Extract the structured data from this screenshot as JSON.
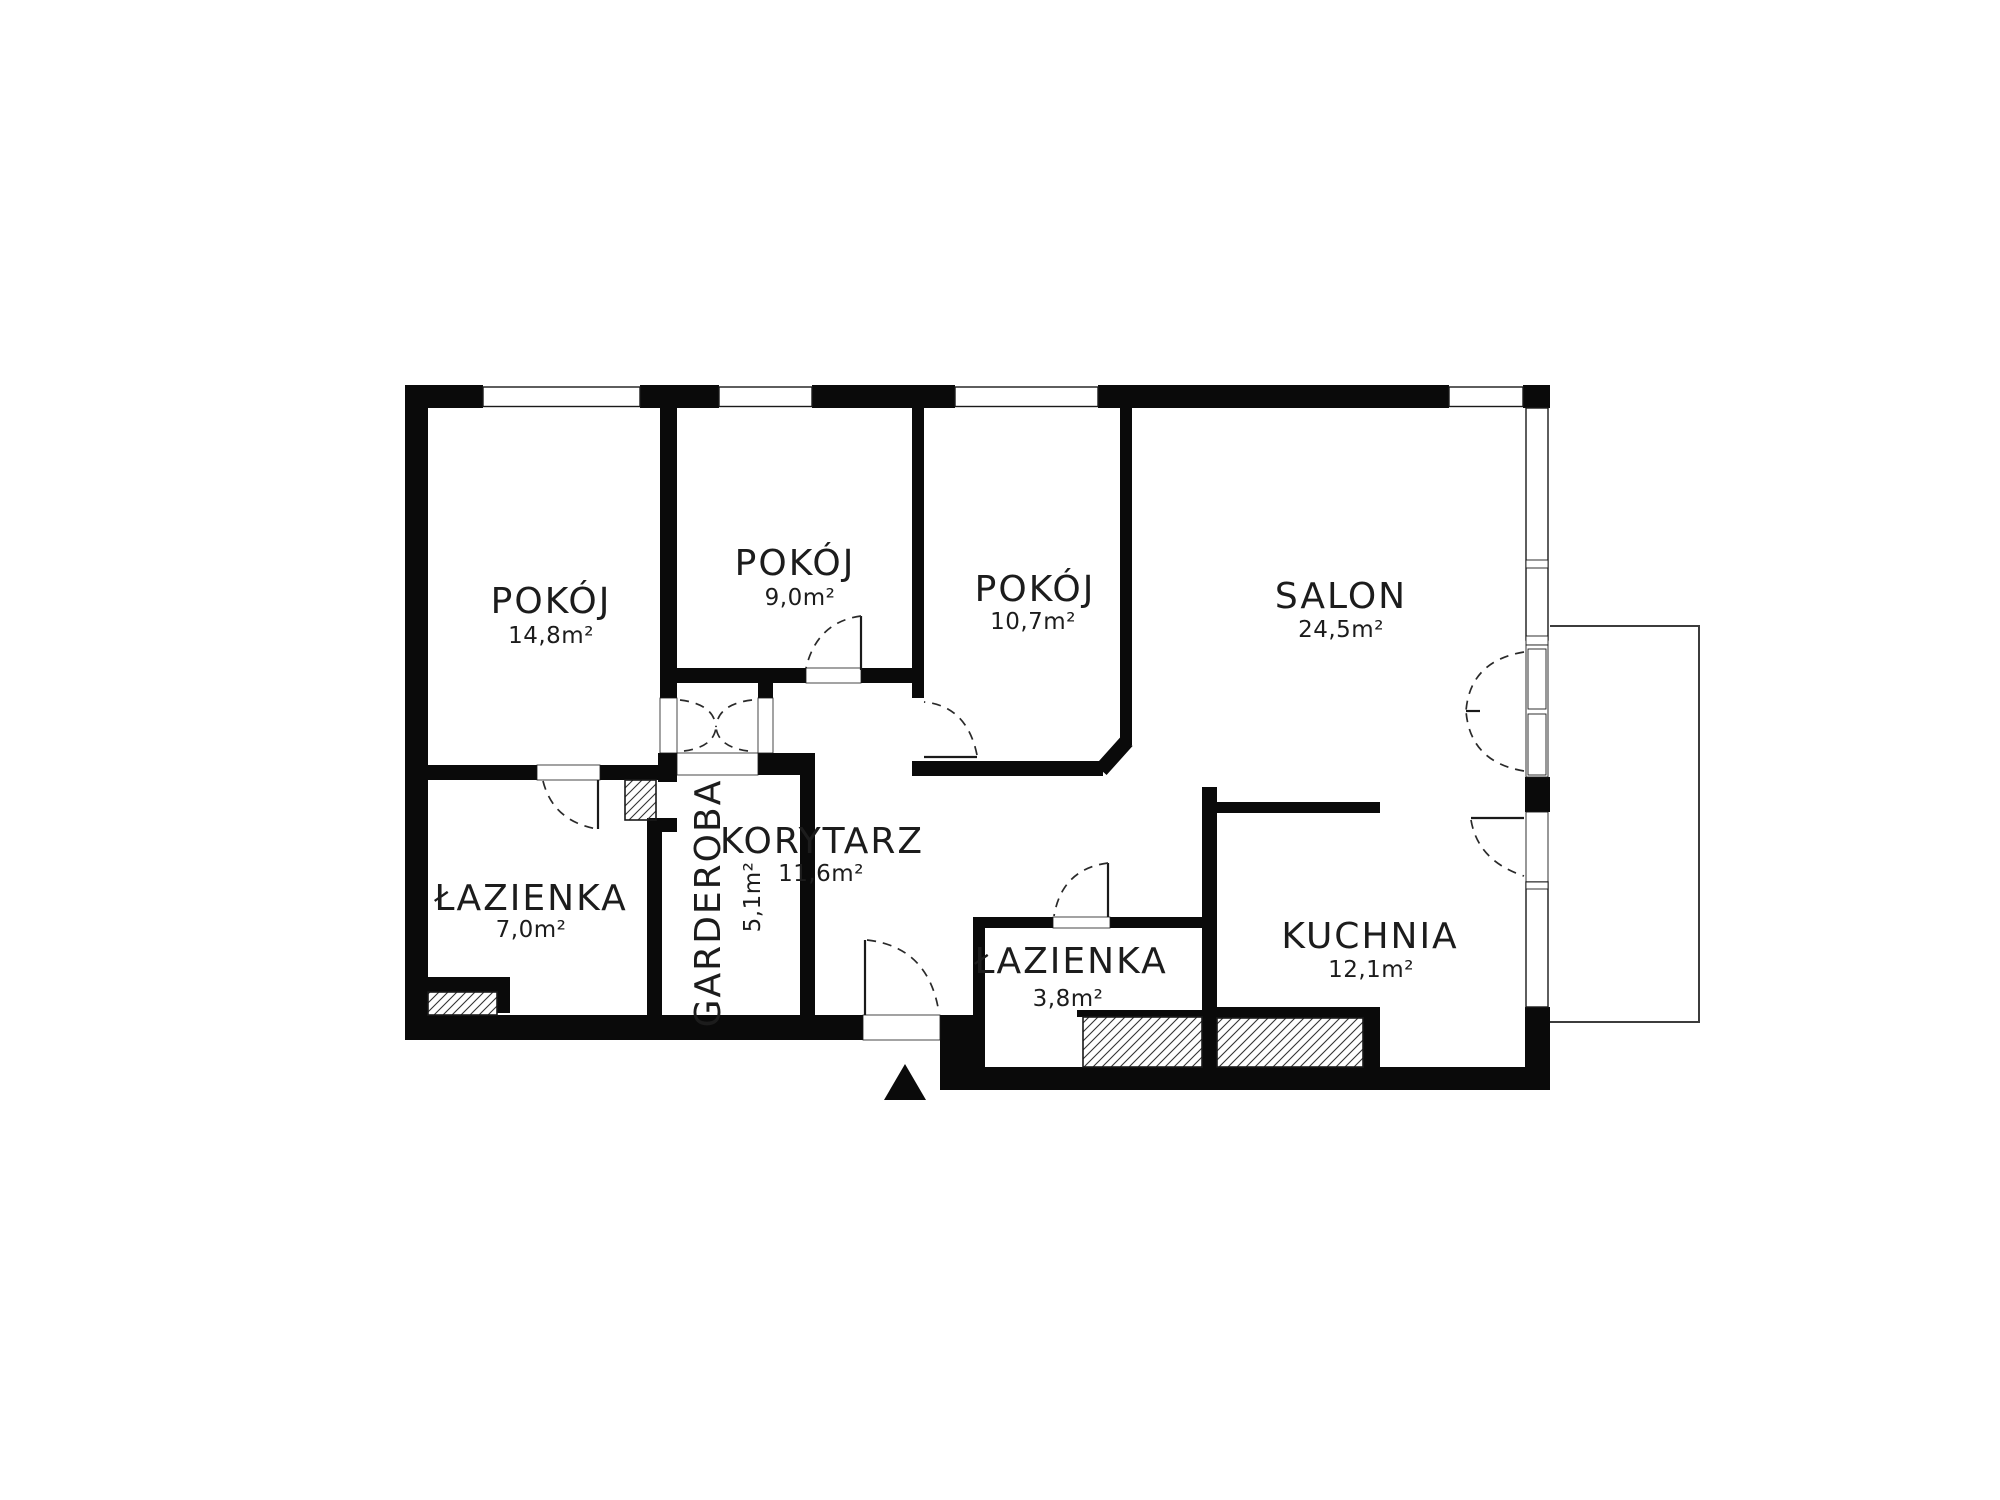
{
  "plan": {
    "rooms": [
      {
        "id": "pokoj-1",
        "label": "POKÓJ",
        "area": "14,8m²"
      },
      {
        "id": "pokoj-2",
        "label": "POKÓJ",
        "area": "9,0m²"
      },
      {
        "id": "pokoj-3",
        "label": "POKÓJ",
        "area": "10,7m²"
      },
      {
        "id": "salon",
        "label": "SALON",
        "area": "24,5m²"
      },
      {
        "id": "lazienka-1",
        "label": "ŁAZIENKA",
        "area": "7,0m²"
      },
      {
        "id": "garderoba",
        "label": "GARDEROBA",
        "area": "5,1m²"
      },
      {
        "id": "korytarz",
        "label": "KORYTARZ",
        "area": "11,6m²"
      },
      {
        "id": "lazienka-2",
        "label": "ŁAZIENKA",
        "area": "3,8m²"
      },
      {
        "id": "kuchnia",
        "label": "KUCHNIA",
        "area": "12,1m²"
      }
    ]
  }
}
